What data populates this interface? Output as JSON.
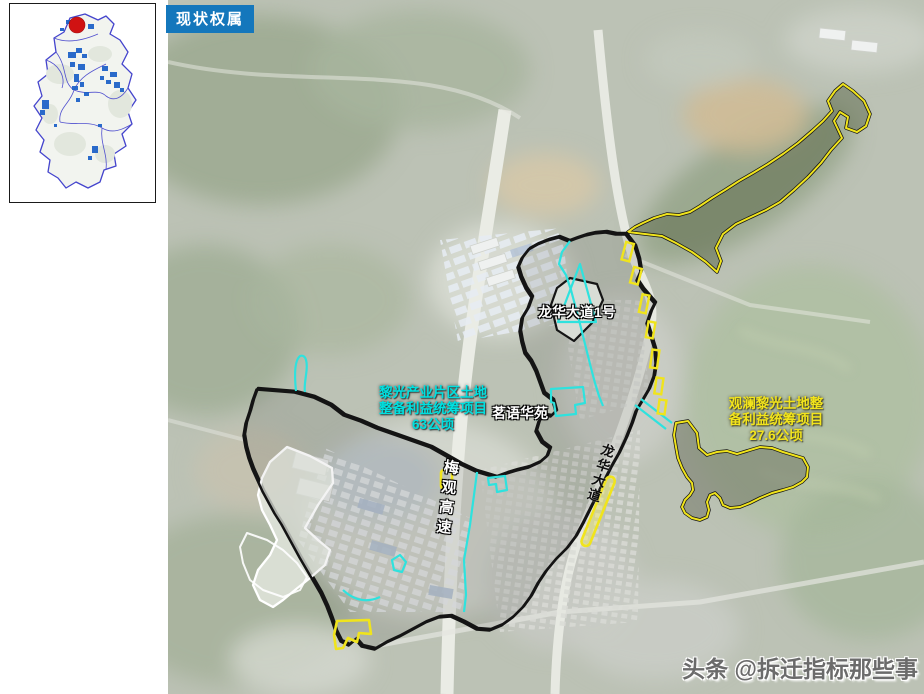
{
  "title_badge": {
    "label": "现状权属"
  },
  "inset_map": {
    "name": "district-location-inset",
    "boundary_color": "#4444cd",
    "builtup_patch_color": "#1f63c8",
    "location_marker_color": "#d01212"
  },
  "labels": {
    "cyan_project": {
      "line1": "黎光产业片区土地",
      "line2": "整备利益统筹项目",
      "line3": "63公顷",
      "color": "#00e0e0"
    },
    "yellow_project": {
      "line1": "观澜黎光土地整",
      "line2": "备利益统筹项目",
      "line3": "27.6公顷",
      "color": "#f2e41c"
    },
    "road_longhua_no1": "龙华大道1号",
    "residence_mingyu": "茗语华苑",
    "expressway_meiguan": "梅观高速",
    "road_longhua": "龙华大道"
  },
  "watermark": {
    "text": "头条 @拆迁指标那些事"
  },
  "colors": {
    "badge_blue": "#1477bc",
    "boundary_black": "#141414",
    "boundary_cyan": "#2ee2de",
    "boundary_yellow": "#f0e41c",
    "excluded_outline_white": "#ffffff"
  }
}
